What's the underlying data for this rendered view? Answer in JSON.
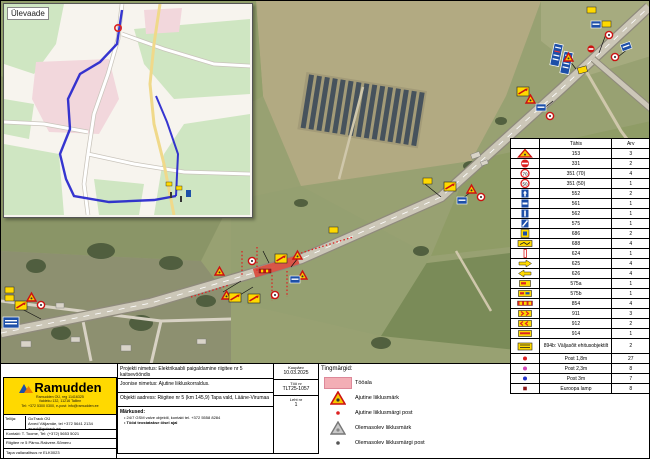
{
  "inset": {
    "label": "Ülevaade"
  },
  "legend_panel": {
    "title": "Tingmärgid:",
    "items": [
      {
        "icon": "work-zone-swatch",
        "label": "Tööala"
      },
      {
        "icon": "temporary-sign-triangle",
        "label": "Ajutine liiklusmärk"
      },
      {
        "icon": "temporary-post-dot",
        "label": "Ajutine liiklusmärgi post"
      },
      {
        "icon": "existing-sign-triangle",
        "label": "Olemasolev liiklusmärk"
      },
      {
        "icon": "existing-post-dot",
        "label": "Olemasolev liiklusmärgi post"
      }
    ]
  },
  "sign_table": {
    "headers": {
      "icon": "",
      "code": "Tähis",
      "count": "Arv"
    },
    "rows": [
      {
        "icon": "warn-triangle",
        "code": "153",
        "count": "3"
      },
      {
        "icon": "no-entry",
        "code": "331",
        "count": "2"
      },
      {
        "icon": "speed-70",
        "code": "351 (70)",
        "count": "4"
      },
      {
        "icon": "speed-50",
        "code": "351 (50)",
        "count": "1"
      },
      {
        "icon": "blue-info",
        "code": "552",
        "count": "2"
      },
      {
        "icon": "blue-info2",
        "code": "561",
        "count": "1"
      },
      {
        "icon": "blue-info3",
        "code": "562",
        "count": "1"
      },
      {
        "icon": "blue-info4",
        "code": "575",
        "count": "1"
      },
      {
        "icon": "yellow-blue",
        "code": "686",
        "count": "2"
      },
      {
        "icon": "yellow-wide",
        "code": "688",
        "count": "4"
      },
      {
        "icon": "post-left",
        "code": "624",
        "count": "1"
      },
      {
        "icon": "arrow-right",
        "code": "625",
        "count": "4"
      },
      {
        "icon": "arrow-left",
        "code": "626",
        "count": "4"
      },
      {
        "icon": "yellow-plate",
        "code": "575a",
        "count": "1"
      },
      {
        "icon": "yellow-plate2",
        "code": "575b",
        "count": "1"
      },
      {
        "icon": "barrier",
        "code": "854",
        "count": "4"
      },
      {
        "icon": "chevron-plate",
        "code": "911",
        "count": "3"
      },
      {
        "icon": "chevron-plate2",
        "code": "912",
        "count": "2"
      },
      {
        "icon": "chevron-plate3",
        "code": "914",
        "count": "1"
      },
      {
        "icon": "exit-plate",
        "code": "894b: Väljasõit ehitusobjektilt",
        "count": "2",
        "tall": true
      },
      {
        "icon": "dot-red",
        "code": "Post 1,8m",
        "count": "27"
      },
      {
        "icon": "dot-magenta",
        "code": "Post 2,3m",
        "count": "8"
      },
      {
        "icon": "dot-blue",
        "code": "Post 3m",
        "count": "7"
      },
      {
        "icon": "dot-darkred",
        "code": "Euroopa lamp",
        "count": "8"
      }
    ]
  },
  "title_block": {
    "project_line": "Projekti nimetus: Elektrikaabli paigaldamine riigitee nr 5 kaitsevööndis",
    "drawing_line": "Joonise nimetus: Ajutine liikluskorraldus.",
    "address_line": "Objekti aadress: Riigitee nr 5 (km 145,9) Tapa vald, Lääne-Virumaa",
    "notes_label": "Märkused:",
    "note_1": "24/7 GSM valve objektil, kontakt tel. +372 5558 8284",
    "note_2": "Tööd teostatakse öisel ajal",
    "meta": [
      {
        "label": "Kuupäev",
        "value": "10.03.2025"
      },
      {
        "label": "Töö nr",
        "value": "TLT25-1057"
      },
      {
        "label": "Leht nr",
        "value": "1"
      }
    ]
  },
  "company": {
    "name": "Ramudden",
    "address_line_1": "Ramudden OÜ, reg 11416325",
    "address_line_2": "Valdeku 132, 11216 Tallinn",
    "address_line_3": "Tel: +372 5300 0300, e-post: info@ramudden.ee",
    "client_label": "Tellija:",
    "client_line_1": "GoTrack OÜ",
    "client_line_2": "Arved Väljamäe, tel +372 5641 2134",
    "client_line_3": "arved@gotrack.ee",
    "contact_line": "Kontakt: T. Toome, Tel: (+372) 5653 5021",
    "road_line": "Riigitee nr 5 Pärnu-Rakvere-Sõmeru",
    "permit_line": "Tapa vallavalitsus nr ELK0023"
  },
  "colors": {
    "ramudden_yellow": "#ffd900",
    "work_zone_pink": "#f3aeb5",
    "work_zone_red": "#d94f40",
    "sign_blue": "#1d4fa8",
    "sign_red": "#cc1111",
    "route_blue": "#2020cc"
  }
}
